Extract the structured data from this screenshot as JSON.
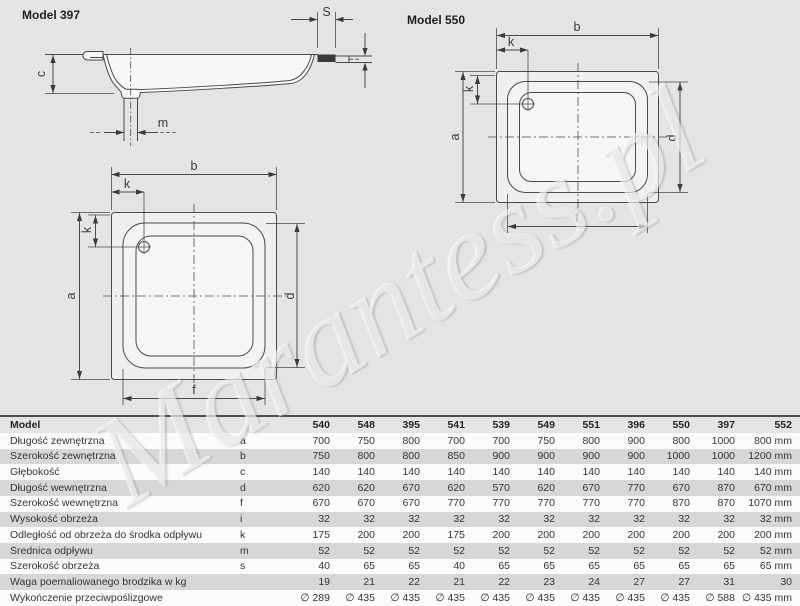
{
  "titles": {
    "left_model": "Model 397",
    "right_model": "Model 550"
  },
  "watermark": {
    "text": "Marantess.pl"
  },
  "diagrams": {
    "side": {
      "s": "S",
      "c": "c",
      "m": "m"
    },
    "square": {
      "b": "b",
      "k_top": "k",
      "k_left": "k",
      "a": "a",
      "d": "d",
      "f": "f"
    },
    "rect": {
      "b": "b",
      "k_top": "k",
      "k_left": "k",
      "a": "a",
      "d": "d",
      "f": "f"
    }
  },
  "table": {
    "model_label": "Model",
    "models": [
      "540",
      "548",
      "395",
      "541",
      "539",
      "549",
      "551",
      "396",
      "550",
      "397",
      "552"
    ],
    "rows": [
      {
        "label": "Długość zewnętrzna",
        "symbol": "a",
        "values": [
          "700",
          "750",
          "800",
          "700",
          "700",
          "750",
          "800",
          "900",
          "800",
          "1000",
          "800 mm"
        ]
      },
      {
        "label": "Szerokość zewnętrzna",
        "symbol": "b",
        "values": [
          "750",
          "800",
          "800",
          "850",
          "900",
          "900",
          "900",
          "900",
          "1000",
          "1000",
          "1200 mm"
        ]
      },
      {
        "label": "Głębokość",
        "symbol": "c",
        "values": [
          "140",
          "140",
          "140",
          "140",
          "140",
          "140",
          "140",
          "140",
          "140",
          "140",
          "140 mm"
        ]
      },
      {
        "label": "Długość wewnętrzna",
        "symbol": "d",
        "values": [
          "620",
          "620",
          "670",
          "620",
          "570",
          "620",
          "670",
          "770",
          "670",
          "870",
          "670 mm"
        ]
      },
      {
        "label": "Szerokość wewnętrzna",
        "symbol": "f",
        "values": [
          "670",
          "670",
          "670",
          "770",
          "770",
          "770",
          "770",
          "770",
          "870",
          "870",
          "1070 mm"
        ]
      },
      {
        "label": "Wysokość obrzeża",
        "symbol": "i",
        "values": [
          "32",
          "32",
          "32",
          "32",
          "32",
          "32",
          "32",
          "32",
          "32",
          "32",
          "32 mm"
        ]
      },
      {
        "label": "Odległość od obrzeża do środka odpływu",
        "symbol": "k",
        "values": [
          "175",
          "200",
          "200",
          "175",
          "200",
          "200",
          "200",
          "200",
          "200",
          "200",
          "200 mm"
        ]
      },
      {
        "label": "Średnica odpływu",
        "symbol": "m",
        "values": [
          "52",
          "52",
          "52",
          "52",
          "52",
          "52",
          "52",
          "52",
          "52",
          "52",
          "52 mm"
        ]
      },
      {
        "label": "Szerokość obrzeża",
        "symbol": "s",
        "values": [
          "40",
          "65",
          "65",
          "40",
          "65",
          "65",
          "65",
          "65",
          "65",
          "65",
          "65 mm"
        ]
      },
      {
        "label": "Waga poemaliowanego brodzika w kg",
        "symbol": "",
        "values": [
          "19",
          "21",
          "22",
          "21",
          "22",
          "23",
          "24",
          "27",
          "27",
          "31",
          "30"
        ]
      },
      {
        "label": "Wykończenie przeciwpoślizgowe",
        "symbol": "",
        "values": [
          "∅ 289",
          "∅ 435",
          "∅ 435",
          "∅ 435",
          "∅ 435",
          "∅ 435",
          "∅ 435",
          "∅ 435",
          "∅ 435",
          "∅ 588",
          "∅ 435 mm"
        ]
      }
    ]
  }
}
